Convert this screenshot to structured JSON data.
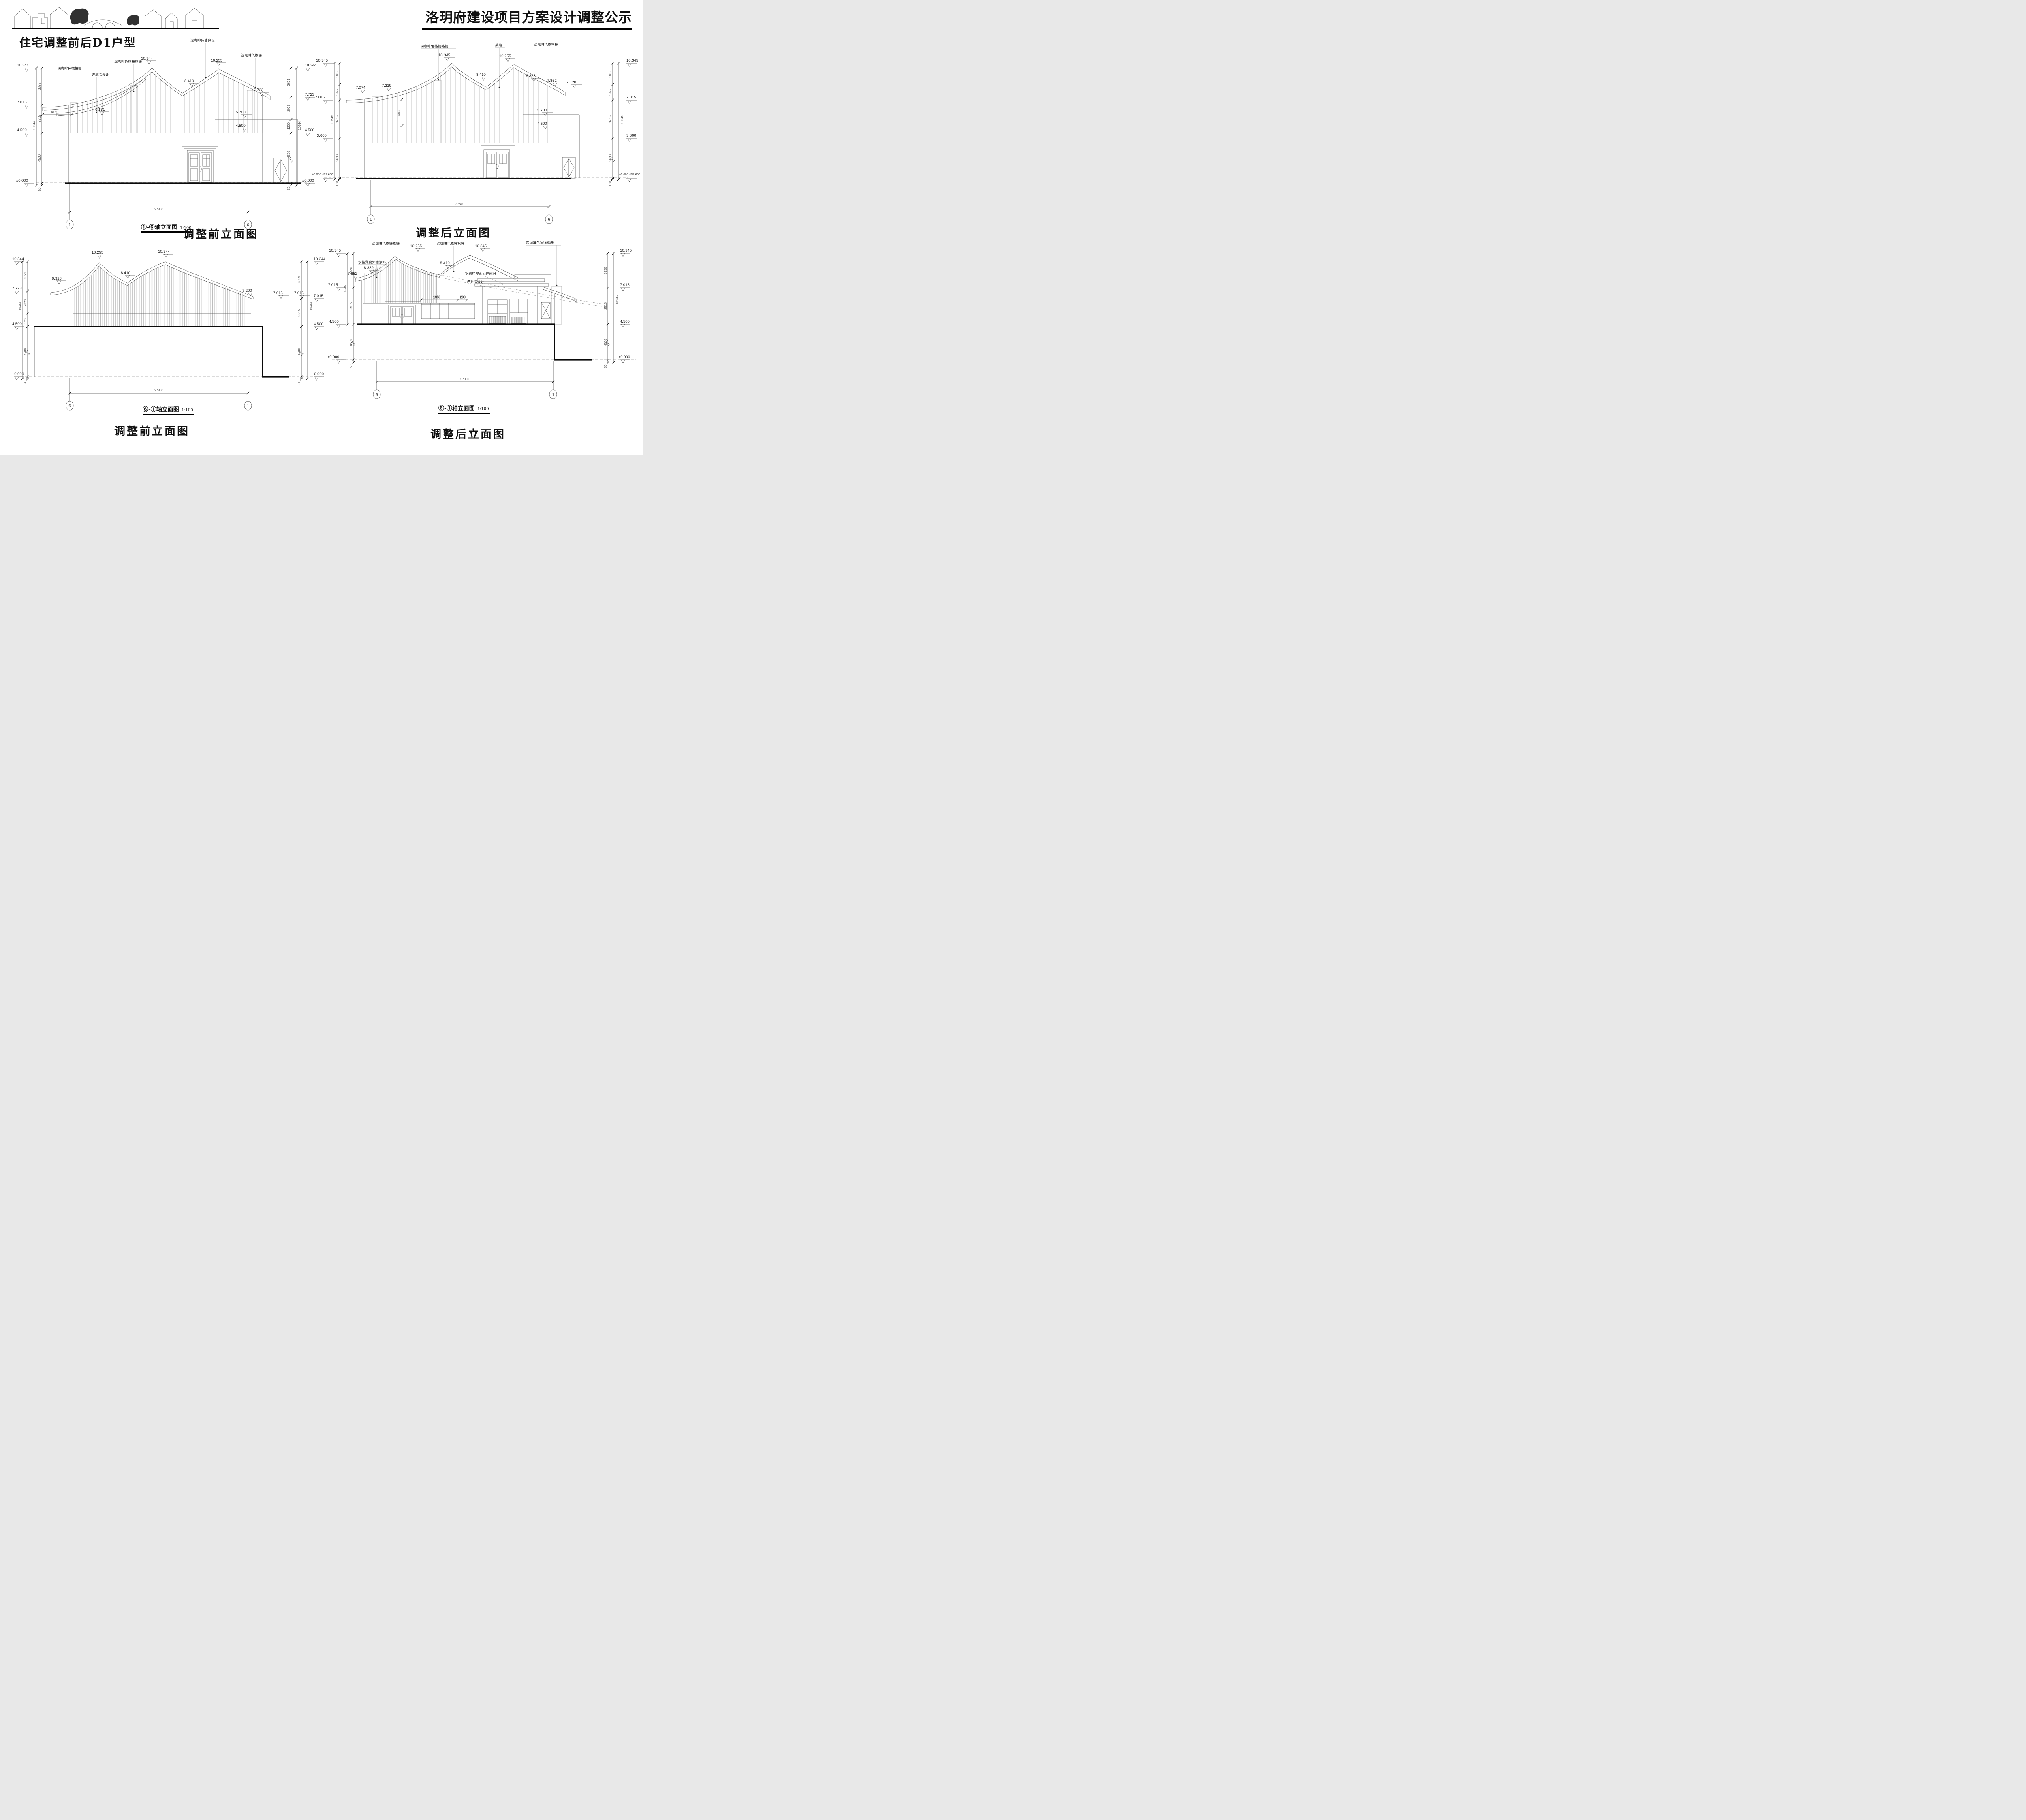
{
  "header": {
    "title": "洛玥府建设项目方案设计调整公示",
    "section_title": "住宅调整前后D1户型",
    "logo": "village-skyline-sketch"
  },
  "drawings": {
    "a": {
      "axis_caption": "①-⑥轴立面图",
      "scale": "1:100",
      "caption": "调整前立面图",
      "grid_left": "1",
      "grid_right": "6",
      "span": "27800",
      "eave_dim": "4150",
      "labels": {
        "l1": "深咖啡色檐格栅",
        "l2": "详幕墙设计",
        "l3": "深咖啡色格栅格栅",
        "l4": "深咖啡色油毡瓦",
        "l5": "深咖啡色格栅"
      },
      "marks": {
        "peak1": "10.344",
        "peak2": "10.255",
        "valley": "8.410",
        "eave_r": "7.723",
        "eave_in": "6.171",
        "lvl57": "5.700",
        "lvl45": "4.500"
      },
      "left": {
        "levels": [
          "10.344",
          "7.015",
          "4.500",
          "±0.000"
        ],
        "segs": [
          "3329",
          "2515",
          "4500",
          "50"
        ],
        "total": "10344"
      },
      "right": {
        "levels": [
          "10.344",
          "7.723",
          "4.500",
          "±0.000"
        ],
        "segs": [
          "2621",
          "2023",
          "1200",
          "4500",
          "50"
        ],
        "total": "10344"
      }
    },
    "b": {
      "caption": "调整后立面图",
      "grid_left": "1",
      "grid_right": "6",
      "span": "27800",
      "eave_dim": "6070",
      "labels": {
        "l1": "深咖啡色格栅格栅",
        "l2": "幕墙",
        "l3": "深咖啡色格格栅"
      },
      "marks": {
        "peak1": "10.345",
        "peak2": "10.255",
        "valley": "8.410",
        "eave_l1": "7.074",
        "eave_l2": "7.219",
        "eave_r1": "8.338",
        "eave_r2": "7.852",
        "eave_r3": "7.720",
        "lvl57": "5.700",
        "lvl45": "4.500"
      },
      "left": {
        "levels": [
          "10.345",
          "7.015",
          "3.600",
          "±0.000 432.600"
        ],
        "segs": [
          "1935",
          "1395",
          "3415",
          "3600",
          "100"
        ],
        "total": "10345"
      },
      "right": {
        "levels": [
          "10.345",
          "7.015",
          "3.600",
          "±0.000 432.600"
        ],
        "segs": [
          "1935",
          "1395",
          "3415",
          "3600",
          "100"
        ],
        "total": "10345"
      }
    },
    "c": {
      "axis_caption": "⑥-①轴立面图",
      "scale": "1:100",
      "caption": "调整前立面图",
      "grid_left": "6",
      "grid_right": "1",
      "span": "27800",
      "marks": {
        "eave_l": "8.328",
        "peak1": "10.255",
        "valley": "8.410",
        "peak2": "10.344",
        "eave_r": "7.200",
        "lvl7a": "7.015",
        "lvl7b": "7.015"
      },
      "left": {
        "levels": [
          "10.344",
          "7.723",
          "4.500",
          "±0.000"
        ],
        "segs": [
          "2621",
          "2023",
          "1200",
          "4500",
          "50"
        ],
        "total": "10344"
      },
      "right": {
        "levels": [
          "10.344",
          "7.015",
          "4.500",
          "±0.000"
        ],
        "segs": [
          "3329",
          "2515",
          "4500",
          "50"
        ],
        "total": "10344"
      }
    },
    "d": {
      "axis_caption": "⑥-①轴立面图",
      "scale": "1:100",
      "caption": "调整后立面图",
      "grid_left": "6",
      "grid_right": "1",
      "span": "27800",
      "labels": {
        "l1": "深咖啡色格栅格栅",
        "l2": "深咖啡色格栅格栅",
        "l3": "深咖啡色装饰格栅",
        "l4": "水性乳胶外墙涂料",
        "l5": "钢结构屋面延伸部分",
        "l6": "详专项设计"
      },
      "marks": {
        "peak1": "10.255",
        "peak2": "10.345",
        "valley": "8.410",
        "eave_l1": "8.339",
        "eave_l2": "7.852",
        "win_w": "1950",
        "win_gap": "200"
      },
      "left": {
        "levels": [
          "10.345",
          "7.015",
          "4.500",
          "±0.000"
        ],
        "segs": [
          "3330",
          "2515",
          "4500",
          "50"
        ],
        "total": "5845"
      },
      "right": {
        "levels": [
          "10.345",
          "7.015",
          "4.500",
          "±0.000"
        ],
        "segs": [
          "3330",
          "2515",
          "4500",
          "50"
        ],
        "total": "10345"
      }
    }
  }
}
